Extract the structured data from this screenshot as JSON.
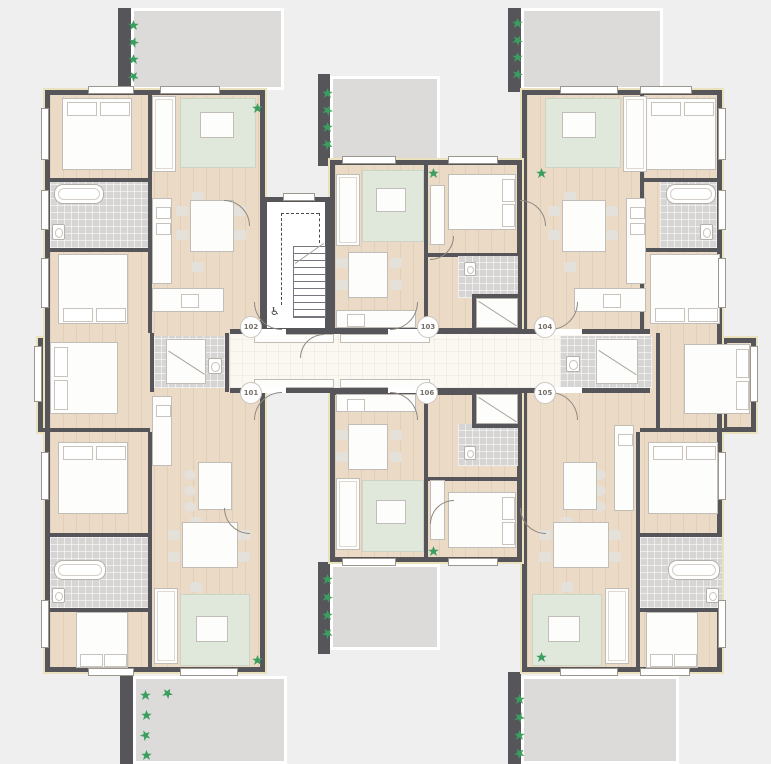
{
  "plan": {
    "units": {
      "u101": "101",
      "u102": "102",
      "u103": "103",
      "u104": "104",
      "u105": "105",
      "u106": "106"
    },
    "icons": {
      "wheelchair": "♿"
    },
    "colors": {
      "bg": "#F0EFEF",
      "wall": "#56555A",
      "wood": "#EBDAC6",
      "bath": "#D6D5D4",
      "rug": "#E0E7DB",
      "terr": "#DCDBD9",
      "corr": "#FBF8F2",
      "furn": "#FDFDFC",
      "plant": "#3A9E5F",
      "trim": "#E9E2BC"
    }
  }
}
